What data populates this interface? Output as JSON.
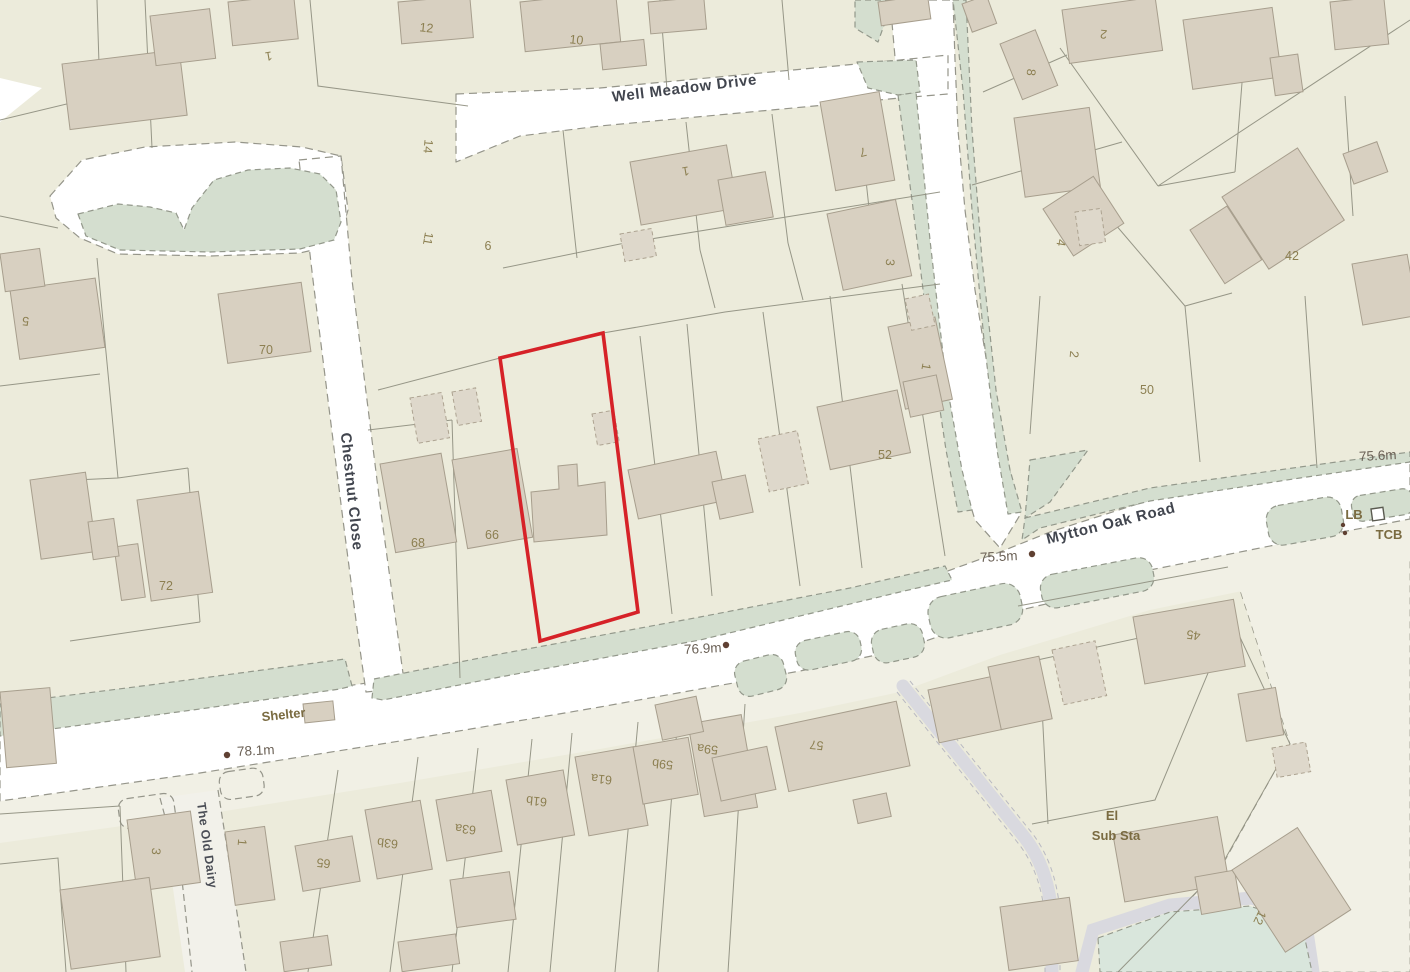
{
  "map": {
    "title": "Site location plan",
    "streets": [
      "Well Meadow Drive",
      "Chestnut Close",
      "Mytton Oak Road",
      "The Old Dairy"
    ],
    "pois": [
      "Shelter",
      "El Sub Sta",
      "LB",
      "TCB"
    ],
    "elevations": [
      "78.1m",
      "76.9m",
      "75.5m",
      "75.6m"
    ],
    "house_numbers": [
      "1",
      "12",
      "10",
      "1",
      "7",
      "3",
      "1",
      "2",
      "8",
      "4",
      "42",
      "2",
      "50",
      "14",
      "11",
      "6",
      "5",
      "70",
      "72",
      "68",
      "66",
      "52",
      "57",
      "59a",
      "59b",
      "61a",
      "61b",
      "63a",
      "63b",
      "65",
      "3",
      "1",
      "45",
      "12"
    ],
    "colors": {
      "background": "#ecebdb",
      "open_area": "#f1f0e5",
      "road": "#ffffff",
      "verge_green": "#d4decf",
      "pond_green": "#d9e6dc",
      "path_grey": "#d9d9df",
      "building": "#d8d0c1",
      "building_stroke": "#a79e8d",
      "outbuilding": "#ded8cb",
      "parcel_line": "#8d8d7d",
      "site_boundary_red": "#d62228",
      "street_text": "#41454e",
      "number_text": "#8c7f51",
      "elevation_text": "#6b6156",
      "poi_text": "#7a6b41"
    },
    "labels": [
      {
        "t": "Well Meadow Drive",
        "x": 685,
        "y": 93,
        "r": -7,
        "k": "street"
      },
      {
        "t": "Chestnut Close",
        "x": 347,
        "y": 492,
        "r": 84,
        "k": "street"
      },
      {
        "t": "Mytton Oak Road",
        "x": 1112,
        "y": 528,
        "r": -14,
        "k": "street"
      },
      {
        "t": "The Old Dairy",
        "x": 203,
        "y": 846,
        "r": 82,
        "k": "street2"
      },
      {
        "t": "1",
        "x": 268,
        "y": 52,
        "r": 170,
        "k": "num"
      },
      {
        "t": "12",
        "x": 426,
        "y": 32,
        "r": 6,
        "k": "num"
      },
      {
        "t": "10",
        "x": 576,
        "y": 44,
        "r": 6,
        "k": "num"
      },
      {
        "t": "1",
        "x": 685,
        "y": 167,
        "r": 170,
        "k": "num"
      },
      {
        "t": "7",
        "x": 862,
        "y": 148,
        "r": 166,
        "k": "num"
      },
      {
        "t": "3",
        "x": 886,
        "y": 262,
        "r": 95,
        "k": "num"
      },
      {
        "t": "1",
        "x": 922,
        "y": 366,
        "r": 100,
        "k": "num"
      },
      {
        "t": "2",
        "x": 1104,
        "y": 30,
        "r": 186,
        "k": "num"
      },
      {
        "t": "8",
        "x": 1027,
        "y": 72,
        "r": 95,
        "k": "num"
      },
      {
        "t": "4",
        "x": 1057,
        "y": 242,
        "r": 100,
        "k": "num"
      },
      {
        "t": "42",
        "x": 1292,
        "y": 260,
        "r": 0,
        "k": "num"
      },
      {
        "t": "2",
        "x": 1070,
        "y": 354,
        "r": 95,
        "k": "num"
      },
      {
        "t": "50",
        "x": 1147,
        "y": 394,
        "r": 0,
        "k": "num"
      },
      {
        "t": "14",
        "x": 424,
        "y": 146,
        "r": 95,
        "k": "num"
      },
      {
        "t": "11",
        "x": 424,
        "y": 238,
        "r": 100,
        "k": "num"
      },
      {
        "t": "6",
        "x": 488,
        "y": 250,
        "r": 0,
        "k": "num"
      },
      {
        "t": "5",
        "x": 26,
        "y": 317,
        "r": 186,
        "k": "num"
      },
      {
        "t": "70",
        "x": 266,
        "y": 354,
        "r": 0,
        "k": "num"
      },
      {
        "t": "72",
        "x": 166,
        "y": 590,
        "r": 0,
        "k": "num"
      },
      {
        "t": "68",
        "x": 418,
        "y": 547,
        "r": 0,
        "k": "num"
      },
      {
        "t": "66",
        "x": 492,
        "y": 539,
        "r": 0,
        "k": "num"
      },
      {
        "t": "52",
        "x": 885,
        "y": 459,
        "r": 0,
        "k": "num"
      },
      {
        "t": "57",
        "x": 817,
        "y": 741,
        "r": 186,
        "k": "num"
      },
      {
        "t": "59a",
        "x": 708,
        "y": 745,
        "r": 186,
        "k": "num"
      },
      {
        "t": "59b",
        "x": 663,
        "y": 760,
        "r": 186,
        "k": "num"
      },
      {
        "t": "61a",
        "x": 602,
        "y": 775,
        "r": 186,
        "k": "num"
      },
      {
        "t": "61b",
        "x": 537,
        "y": 797,
        "r": 186,
        "k": "num"
      },
      {
        "t": "63a",
        "x": 466,
        "y": 825,
        "r": 186,
        "k": "num"
      },
      {
        "t": "63b",
        "x": 388,
        "y": 839,
        "r": 186,
        "k": "num"
      },
      {
        "t": "65",
        "x": 324,
        "y": 859,
        "r": 186,
        "k": "num"
      },
      {
        "t": "3",
        "x": 152,
        "y": 851,
        "r": 95,
        "k": "num"
      },
      {
        "t": "1",
        "x": 238,
        "y": 842,
        "r": 95,
        "k": "num"
      },
      {
        "t": "45",
        "x": 1194,
        "y": 631,
        "r": 188,
        "k": "num"
      },
      {
        "t": "12",
        "x": 1256,
        "y": 916,
        "r": 115,
        "k": "num"
      },
      {
        "t": "Shelter",
        "x": 284,
        "y": 719,
        "r": -6,
        "k": "poi"
      },
      {
        "t": "El",
        "x": 1112,
        "y": 820,
        "r": 0,
        "k": "poi"
      },
      {
        "t": "Sub Sta",
        "x": 1116,
        "y": 840,
        "r": 0,
        "k": "poi"
      },
      {
        "t": "LB",
        "x": 1354,
        "y": 519,
        "r": 0,
        "k": "poi"
      },
      {
        "t": "TCB",
        "x": 1389,
        "y": 539,
        "r": 0,
        "k": "poi"
      },
      {
        "t": "78.1m",
        "x": 256,
        "y": 755,
        "r": -3,
        "k": "elev"
      },
      {
        "t": "76.9m",
        "x": 703,
        "y": 653,
        "r": -3,
        "k": "elev"
      },
      {
        "t": "75.5m",
        "x": 999,
        "y": 561,
        "r": -3,
        "k": "elev"
      },
      {
        "t": "75.6m",
        "x": 1378,
        "y": 460,
        "r": -3,
        "k": "elev"
      }
    ],
    "benchmarks": [
      {
        "x": 227,
        "y": 755
      },
      {
        "x": 726,
        "y": 645
      },
      {
        "x": 1032,
        "y": 554
      }
    ],
    "lb_dots": [
      {
        "x": 1343,
        "y": 525
      },
      {
        "x": 1345,
        "y": 533
      }
    ],
    "tcb_box": {
      "x": 1371,
      "y": 509,
      "w": 12,
      "h": 12,
      "r": -8
    },
    "site_boundary_points": "500,358 603,333 638,612 540,641"
  }
}
